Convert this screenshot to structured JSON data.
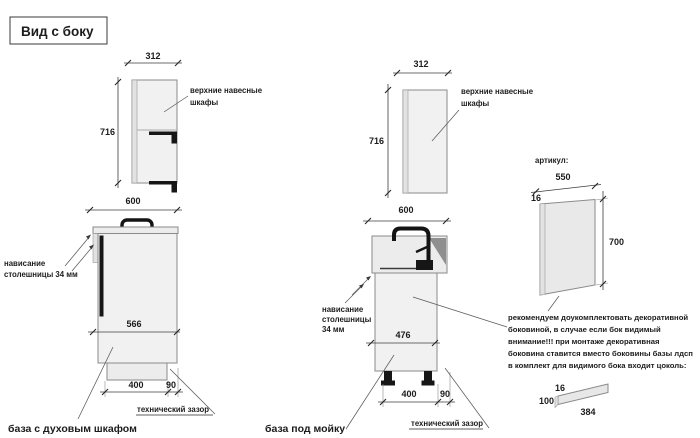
{
  "title": "Вид с боку",
  "colors": {
    "attention_red": "#c0392b",
    "cabinet_fill": "#f1f1f1",
    "sink_shadow": "#8f8f8f",
    "hardware_black": "#161616"
  },
  "left": {
    "upper": {
      "width": "312",
      "height": "716",
      "label_line1": "верхние навесные",
      "label_line2": "шкафы"
    },
    "base": {
      "width": "600",
      "overhang_line1": "нависание",
      "overhang_line2": "столешницы 34 мм",
      "inner_width": "566",
      "plinth_depth": "400",
      "gap": "90",
      "gap_label": "технический зазор",
      "caption": "база с духовым шкафом"
    }
  },
  "middle": {
    "upper": {
      "width": "312",
      "height": "716",
      "label_line1": "верхние навесные",
      "label_line2": "шкафы"
    },
    "base": {
      "width": "600",
      "overhang_line1": "нависание",
      "overhang_line2": "столешницы",
      "overhang_line3": "34 мм",
      "inner_width": "476",
      "plinth_depth": "400",
      "gap": "90",
      "gap_label": "технический зазор",
      "caption": "база под мойку"
    }
  },
  "right": {
    "article_label": "артикул:",
    "side_panel": {
      "width": "550",
      "thickness": "16",
      "height": "700"
    },
    "note": {
      "line1": "рекомендуем доукомплектовать декоративной",
      "line2": "боковиной, в случае если бок видимый",
      "line3": "внимание!!! при монтаже декоративная",
      "line4": "боковина ставится вместо боковины базы лдсп",
      "line5": "в комплект для видимого бока входит цоколь:"
    },
    "plinth": {
      "thickness": "16",
      "height": "100",
      "length": "384"
    }
  }
}
